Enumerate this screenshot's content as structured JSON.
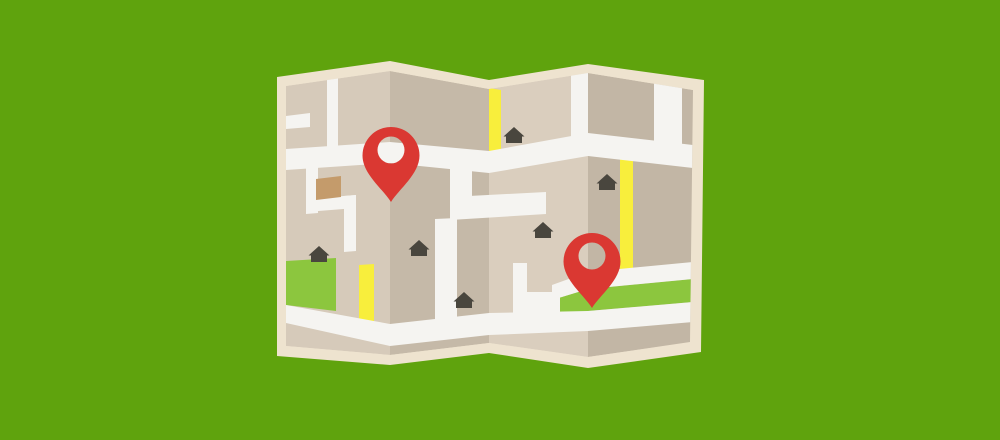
{
  "scene": {
    "description": "Flat vector illustration of a folded paper street map with two red location pins, on a solid green background",
    "background_color": "#5FA30D"
  },
  "map": {
    "paper_border_color": "#EEE3CF",
    "panel_count": 4,
    "panel_colors": {
      "panel_1": "#D6CABA",
      "panel_2": "#C5B9A8",
      "panel_3": "#DACEBE",
      "panel_4": "#C2B6A5"
    },
    "road_color": "#F5F4F1",
    "highlight_road_color": "#F8EE3C",
    "park_color": "#8CC63E",
    "house_color": "#49463E",
    "building_color": "#C49B6B"
  },
  "pins": {
    "color": "#DA3832",
    "count": 2,
    "items": [
      {
        "id": "pin-left",
        "tip_x": 391,
        "tip_y": 202
      },
      {
        "id": "pin-right",
        "tip_x": 592,
        "tip_y": 308
      }
    ]
  },
  "houses": {
    "count": 6,
    "positions": [
      {
        "x": 514,
        "y": 143
      },
      {
        "x": 607,
        "y": 190
      },
      {
        "x": 543,
        "y": 238
      },
      {
        "x": 319,
        "y": 262
      },
      {
        "x": 419,
        "y": 256
      },
      {
        "x": 464,
        "y": 308
      }
    ]
  }
}
